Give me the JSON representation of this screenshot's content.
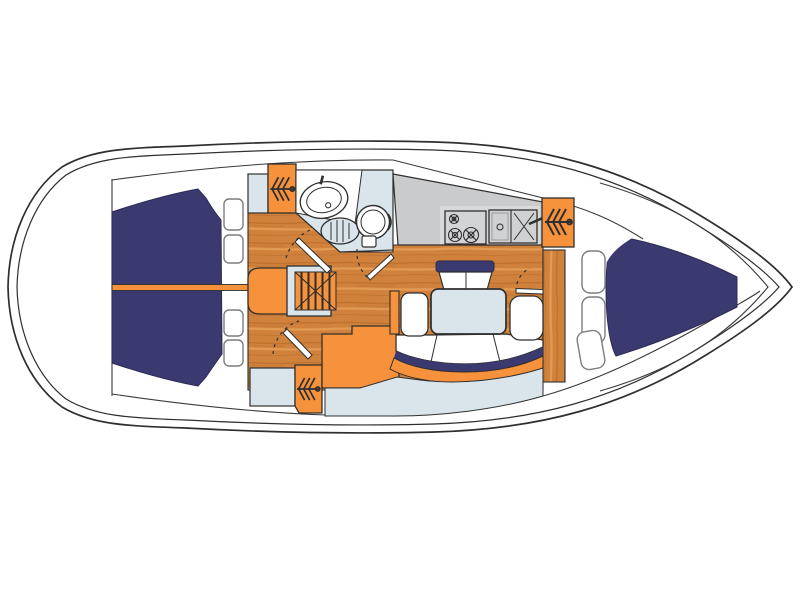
{
  "diagram": {
    "kind": "sailboat-interior-floor-plan-top-view",
    "text_labels": [],
    "regions": {
      "aft_cabin": "double berth with center seam line",
      "companionway": "stairs with ladder rungs",
      "head": "sink, shower seat and toilet",
      "galley": "counter with 3-burner stove and double sink",
      "salon": "dinette table with bench seats and curved settee",
      "forward_cabin": "v-berth with side cushions",
      "hanging_lockers": 3,
      "hull_windows": 4,
      "doors_with_swing_arcs": 4
    }
  },
  "colors": {
    "hull_white": "#ffffff",
    "outline": "#2f2f2f",
    "navy": "#3b3a70",
    "orange": "#f6923b",
    "wood_base": "#d0823c",
    "wood_dark": "#b5682a",
    "wood_light": "#e9a159",
    "light_blue": "#dae5eb",
    "gray": "#c9cbcd",
    "gray_light": "#d8d9da",
    "window_stroke": "#7d7d7d"
  }
}
